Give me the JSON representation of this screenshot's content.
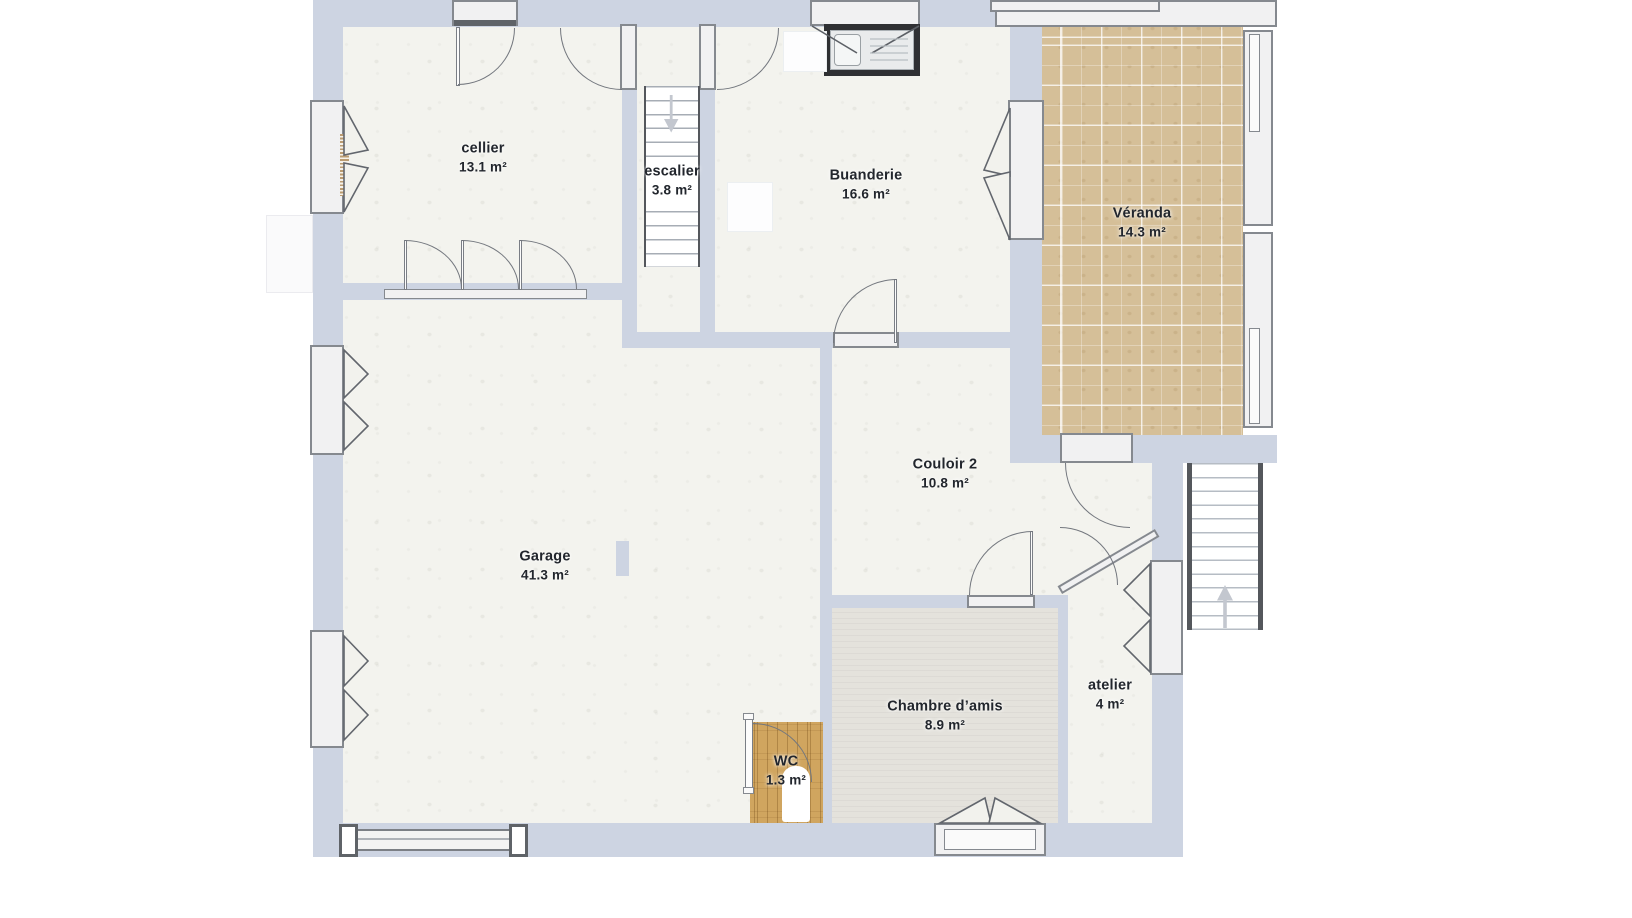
{
  "plan": {
    "kind": "floor-plan",
    "language": "fr",
    "unit_suffix": "m²"
  },
  "rooms": [
    {
      "id": "cellier",
      "name": "cellier",
      "area": "13.1 m²"
    },
    {
      "id": "escalier",
      "name": "escalier",
      "area": "3.8 m²"
    },
    {
      "id": "buanderie",
      "name": "Buanderie",
      "area": "16.6 m²"
    },
    {
      "id": "veranda",
      "name": "Véranda",
      "area": "14.3 m²"
    },
    {
      "id": "couloir-2",
      "name": "Couloir 2",
      "area": "10.8 m²"
    },
    {
      "id": "garage",
      "name": "Garage",
      "area": "41.3 m²"
    },
    {
      "id": "chambre-amis",
      "name": "Chambre d’amis",
      "area": "8.9 m²"
    },
    {
      "id": "wc",
      "name": "WC",
      "area": "1.3 m²"
    },
    {
      "id": "atelier",
      "name": "atelier",
      "area": "4 m²"
    }
  ],
  "icons": {
    "interior_stairs_arrow": "arrow-down",
    "exterior_stairs_arrow": "arrow-up",
    "fixtures": [
      "sink",
      "toilet",
      "roller-shutter-coil"
    ]
  },
  "colors": {
    "wall": "#cdd4e2",
    "floor": "#f3f3ee",
    "veranda_tile": "#d5bf98",
    "wood": "#d0a55f",
    "chambre_floor": "#e4e2dc",
    "frame": "#85898f",
    "label_text": "#22262d"
  }
}
